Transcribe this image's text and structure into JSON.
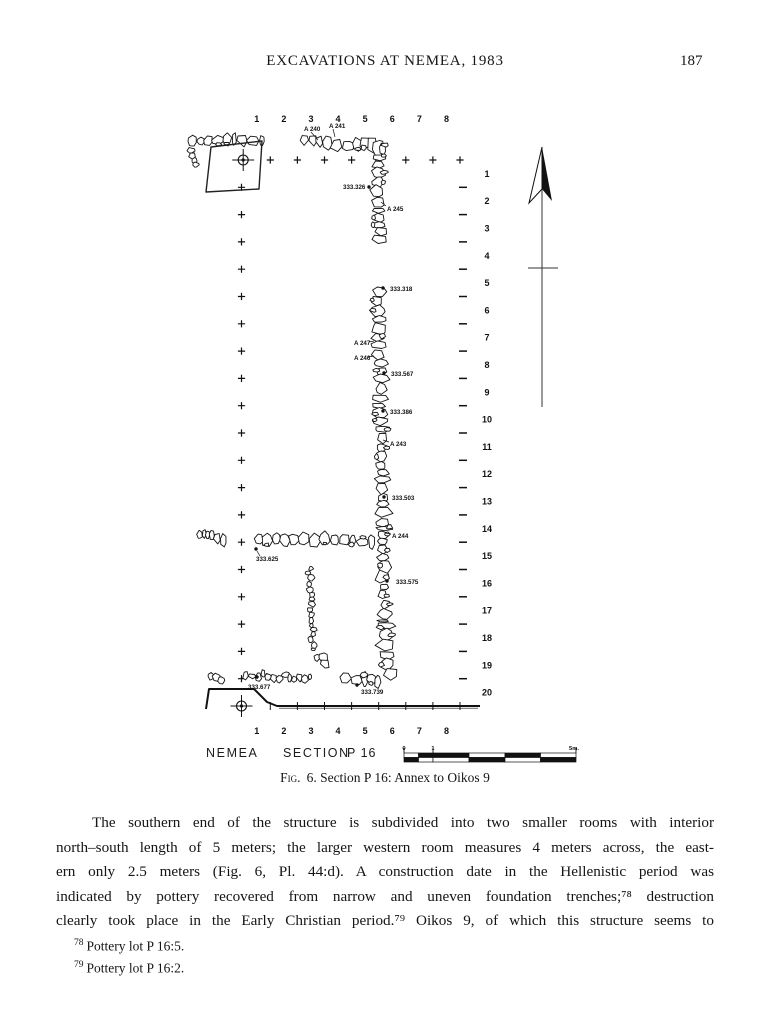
{
  "page": {
    "header_title": "EXCAVATIONS AT NEMEA, 1983",
    "page_number": "187"
  },
  "figure": {
    "site_label": "NEMEA",
    "section_label": "SECTION",
    "section_number": "P 16",
    "caption_label": "Fig.",
    "caption_text": "6. Section P 16: Annex to Oikos 9",
    "scale_bar": {
      "labels": [
        "0",
        "1",
        "5m."
      ]
    },
    "plan": {
      "cols": [
        "1",
        "2",
        "3",
        "4",
        "5",
        "6",
        "7",
        "8"
      ],
      "rows": [
        "1",
        "2",
        "3",
        "4",
        "5",
        "6",
        "7",
        "8",
        "9",
        "10",
        "11",
        "12",
        "13",
        "14",
        "15",
        "16",
        "17",
        "18",
        "19",
        "20"
      ],
      "grid": {
        "x0": 243.2,
        "dx": 27.1,
        "y0": 160,
        "dy": 27.3,
        "plus_col_x": 241.5,
        "dash_x1": 459,
        "dash_x2": 467,
        "row_num_x": 487,
        "top_num_y": 122,
        "bottom_num_y": 734
      },
      "elevation_labels": [
        {
          "t": "A 240",
          "x": 304,
          "y": 131,
          "lead": [
            311,
            132,
            318,
            140
          ]
        },
        {
          "t": "A 241",
          "x": 329,
          "y": 128,
          "lead": [
            333,
            129,
            335,
            137
          ]
        },
        {
          "t": "333.326",
          "x": 343,
          "y": 189,
          "dot": [
            369,
            187
          ]
        },
        {
          "t": "A 245",
          "x": 387,
          "y": 211,
          "lead": [
            386,
            206,
            381,
            202
          ]
        },
        {
          "t": "333.318",
          "x": 390,
          "y": 291,
          "dot": [
            383,
            288
          ]
        },
        {
          "t": "A 247",
          "x": 354,
          "y": 345,
          "lead": [
            369,
            342,
            374,
            341
          ]
        },
        {
          "t": "A 246",
          "x": 354,
          "y": 360,
          "lead": [
            368,
            357,
            374,
            356
          ]
        },
        {
          "t": "333.567",
          "x": 391,
          "y": 376,
          "dot": [
            384,
            373
          ]
        },
        {
          "t": "333.386",
          "x": 390,
          "y": 414,
          "dot": [
            383,
            411
          ]
        },
        {
          "t": "A 243",
          "x": 390,
          "y": 446,
          "lead": [
            389,
            442,
            383,
            440
          ]
        },
        {
          "t": "333.503",
          "x": 392,
          "y": 500,
          "dot": [
            384,
            497
          ]
        },
        {
          "t": "A 244",
          "x": 392,
          "y": 538,
          "lead": [
            391,
            534,
            385,
            533
          ]
        },
        {
          "t": "333.625",
          "x": 256,
          "y": 561,
          "dot": [
            256,
            549
          ],
          "lead": [
            260,
            556,
            257,
            551
          ]
        },
        {
          "t": "333.575",
          "x": 396,
          "y": 584,
          "dot": [
            387,
            581
          ]
        },
        {
          "t": "333.677",
          "x": 248,
          "y": 689,
          "dot": [
            257,
            677
          ]
        },
        {
          "t": "333.739",
          "x": 361,
          "y": 694,
          "dot": [
            357,
            685
          ]
        }
      ],
      "walls": [
        {
          "x1": 187,
          "y1": 141,
          "x2": 264,
          "y2": 139,
          "w": 11,
          "seed": 11
        },
        {
          "x1": 188,
          "y1": 149,
          "x2": 197,
          "y2": 165,
          "w": 8,
          "pebble": true,
          "seed": 12
        },
        {
          "x1": 299,
          "y1": 140,
          "x2": 361,
          "y2": 146,
          "w": 13,
          "seed": 13
        },
        {
          "x1": 361,
          "y1": 141,
          "x2": 383,
          "y2": 150,
          "w": 14,
          "seed": 14
        },
        {
          "x1": 378,
          "y1": 153,
          "x2": 380,
          "y2": 243,
          "w": 15,
          "seed": 15
        },
        {
          "x1": 378,
          "y1": 286,
          "x2": 381,
          "y2": 432,
          "w": 14,
          "seed": 16
        },
        {
          "x1": 381,
          "y1": 432,
          "x2": 383,
          "y2": 530,
          "w": 14,
          "seed": 17
        },
        {
          "x1": 383,
          "y1": 530,
          "x2": 384,
          "y2": 622,
          "w": 13,
          "seed": 18
        },
        {
          "x1": 385,
          "y1": 622,
          "x2": 389,
          "y2": 678,
          "w": 17,
          "seed": 19
        },
        {
          "x1": 339,
          "y1": 678,
          "x2": 380,
          "y2": 680,
          "w": 13,
          "seed": 20
        },
        {
          "x1": 254,
          "y1": 539,
          "x2": 375,
          "y2": 541,
          "w": 13,
          "seed": 21
        },
        {
          "x1": 196,
          "y1": 536,
          "x2": 226,
          "y2": 539,
          "w": 14,
          "pebble": true,
          "seed": 22
        },
        {
          "x1": 309,
          "y1": 566,
          "x2": 313,
          "y2": 649,
          "w": 9,
          "pebble": true,
          "seed": 23
        },
        {
          "x1": 316,
          "y1": 654,
          "x2": 329,
          "y2": 664,
          "w": 11,
          "pebble": true,
          "seed": 24
        },
        {
          "x1": 242,
          "y1": 674,
          "x2": 311,
          "y2": 679,
          "w": 11,
          "pebble": true,
          "seed": 25
        },
        {
          "x1": 208,
          "y1": 674,
          "x2": 224,
          "y2": 679,
          "w": 12,
          "pebble": true,
          "seed": 26
        }
      ],
      "trench": [
        [
          211,
          147
        ],
        [
          262,
          141
        ],
        [
          259,
          189
        ],
        [
          206,
          192
        ]
      ],
      "scarp": {
        "pts": [
          [
            206,
            709
          ],
          [
            209,
            689
          ],
          [
            254,
            689
          ],
          [
            267,
            702
          ],
          [
            277,
            706
          ],
          [
            480,
            706
          ]
        ]
      },
      "north_arrow": {
        "apex": [
          542,
          147
        ],
        "left": [
          529,
          203
        ],
        "right": [
          552,
          201
        ],
        "notch": [
          542,
          189
        ],
        "shaft_end": 407,
        "crossbar": {
          "y": 268,
          "x1": 528,
          "x2": 558
        }
      },
      "scalebar": {
        "bounds": [
          404,
          418.5,
          433,
          469,
          505,
          540.5,
          576
        ],
        "top": 753,
        "h": 4.5
      }
    }
  },
  "body": {
    "lines": [
      "The southern end of the structure is subdivided into two smaller rooms with interior",
      "north–south length of 5 meters; the larger western room measures 4 meters across, the east-",
      "ern only 2.5 meters (Fig. 6, Pl. 44:d). A construction date in the Hellenistic period was",
      "indicated by pottery recovered from narrow and uneven foundation trenches;⁷⁸ destruction",
      "clearly took place in the Early Christian period.⁷⁹ Oikos 9, of which this structure seems to"
    ]
  },
  "footnotes": [
    {
      "num": "78",
      "text": "Pottery lot P 16:5."
    },
    {
      "num": "79",
      "text": "Pottery lot P 16:2."
    }
  ]
}
